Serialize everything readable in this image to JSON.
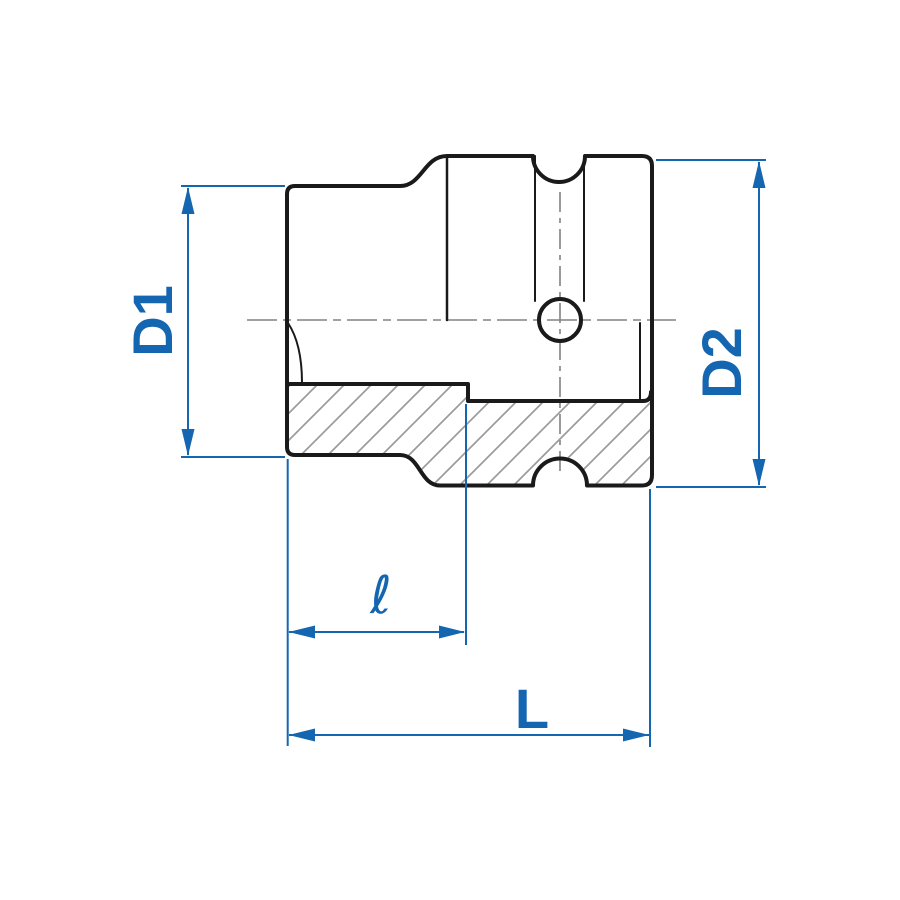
{
  "drawing": {
    "title": "socket-half-section-dimension-drawing",
    "dimensions": {
      "d1_label": "D1",
      "d2_label": "D2",
      "depth_label": "ℓ",
      "length_label": "L"
    },
    "colors": {
      "dimension_blue": "#1566b1",
      "outline_black": "#1a1a1a",
      "centerline_gray": "#828282",
      "hatch_gray": "#9b9b9b",
      "background": "#ffffff"
    }
  }
}
